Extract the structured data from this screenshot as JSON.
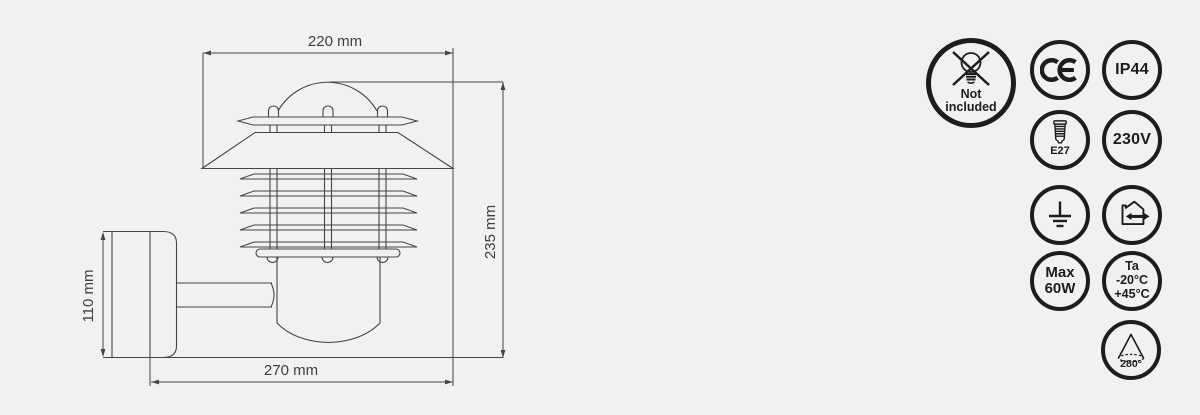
{
  "page": {
    "background": "#f1f1f2"
  },
  "drawing": {
    "dim_top": "220 mm",
    "dim_right": "235 mm",
    "dim_left": "110 mm",
    "dim_bottom": "270 mm"
  },
  "badges": {
    "not_included": {
      "line1": "Not",
      "line2": "included"
    },
    "ce_mark": "CE",
    "ip_rating": "IP44",
    "socket": "E27",
    "voltage": "230V",
    "max_wattage": {
      "line1": "Max",
      "line2": "60W"
    },
    "ambient_temp": {
      "line1": "Ta",
      "line2": "-20°C",
      "line3": "+45°C"
    },
    "beam_angle": "280°"
  },
  "colors": {
    "line": "#454545",
    "icon": "#1d1d1b",
    "label": "#3f3f3f"
  }
}
